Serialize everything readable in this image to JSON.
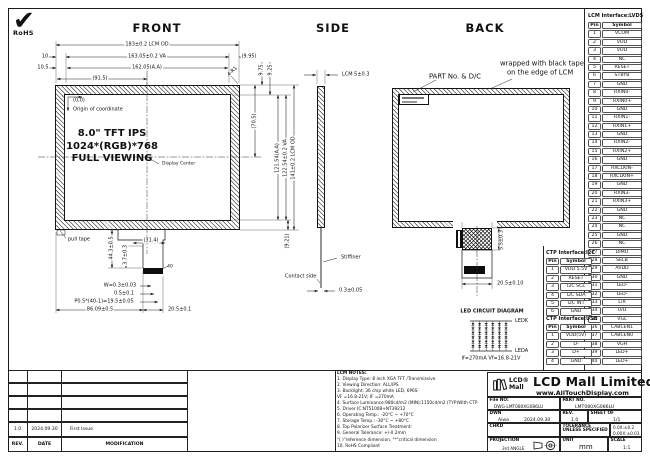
{
  "sheet": {
    "rohs_check": "✔",
    "rohs_label": "RoHS"
  },
  "front": {
    "title": "FRONT",
    "display_lines": [
      "8.0\" TFT IPS",
      "1024*(RGB)*768",
      "FULL VIEWING"
    ],
    "origin_coord": "(0,0)",
    "origin_label": "Origin of coordinate",
    "display_center": "Display Center",
    "pull_tape": "pull tape",
    "dims": {
      "od_w": "183±0.2 LCM OD",
      "va_w": "163.05±0.2 VA",
      "aa_w": "162.05(A.A)",
      "half_w": "(91.5)",
      "m10": "10",
      "m105": "10.5",
      "m995": "(9.95)",
      "r1": "4-R1",
      "m975": "9.75",
      "m925": "9.25",
      "half_h": "(70.5)",
      "aa_h": "121.54(A.A)",
      "va_h": "122.54±0.2 VA",
      "od_h": "141±0.2 LCM OD",
      "m921": "(9.21)",
      "fpc_l": "44.3±0.5",
      "fpc_n": "3.7±0.3",
      "fpc_w": "(31.4)",
      "pin40": "40",
      "pin_w": "W=0.3±0.03",
      "pin_e": "0.5±0.1",
      "pin_p": "P0.5*(40-1)=19.5±0.05",
      "fpc_x": "86.09±0.5",
      "conn_w": "20.5±0.1"
    }
  },
  "side": {
    "title": "SIDE",
    "thk": "LCM 5±0.3",
    "stiffener": "Stiffiner",
    "contact": "Contact side",
    "fpc_thk": "0.3±0.05"
  },
  "back": {
    "title": "BACK",
    "partno_note": "PART No. & D/C",
    "tape_note1": "wrapped with black tape",
    "tape_note2": "on the edge of LCM",
    "fpc_h": "5.5±0.3",
    "conn_w": "20.5±0.10"
  },
  "led": {
    "title": "LED CIRCUIT DIAGRAM",
    "k": "LEDK",
    "a": "LEDA",
    "spec": "If=270mA  Vf=16.8-21V"
  },
  "lvds": {
    "title": "LCM Interface:LVDS",
    "headers": [
      "Pin",
      "Symbol"
    ],
    "rows": [
      [
        "1",
        "VCOM"
      ],
      [
        "2",
        "VDD"
      ],
      [
        "3",
        "VDD"
      ],
      [
        "4",
        "NC"
      ],
      [
        "5",
        "RESET"
      ],
      [
        "6",
        "STBYB"
      ],
      [
        "7",
        "GND"
      ],
      [
        "8",
        "RXIN0-"
      ],
      [
        "9",
        "RXIN0+"
      ],
      [
        "10",
        "GND"
      ],
      [
        "11",
        "RXIN1-"
      ],
      [
        "12",
        "RXIN1+"
      ],
      [
        "13",
        "GND"
      ],
      [
        "14",
        "RXIN2-"
      ],
      [
        "15",
        "RXIN2+"
      ],
      [
        "16",
        "GND"
      ],
      [
        "17",
        "RXCLKIN-"
      ],
      [
        "18",
        "RXCLKIN+"
      ],
      [
        "19",
        "GND"
      ],
      [
        "20",
        "RXIN3-"
      ],
      [
        "21",
        "RXIN3+"
      ],
      [
        "22",
        "GND"
      ],
      [
        "23",
        "NC"
      ],
      [
        "24",
        "NC"
      ],
      [
        "25",
        "GND"
      ],
      [
        "26",
        "NC"
      ],
      [
        "27",
        "DIMO"
      ],
      [
        "28",
        "SELB"
      ],
      [
        "29",
        "AVDD"
      ],
      [
        "30",
        "GND"
      ],
      [
        "31",
        "LED-"
      ],
      [
        "32",
        "LED-"
      ],
      [
        "33",
        "L/R"
      ],
      [
        "34",
        "U/D"
      ],
      [
        "35",
        "VGL"
      ],
      [
        "36",
        "CABCEN1"
      ],
      [
        "37",
        "CABCEN0"
      ],
      [
        "38",
        "VGH"
      ],
      [
        "39",
        "LED+"
      ],
      [
        "40",
        "LED+"
      ]
    ]
  },
  "ctp_i2c": {
    "title": "CTP Interface:I2C",
    "headers": [
      "Pin",
      "Symbol"
    ],
    "rows": [
      [
        "1",
        "VDD 5.5V"
      ],
      [
        "2",
        "RESET"
      ],
      [
        "3",
        "I2C SCL"
      ],
      [
        "4",
        "I2C SDA"
      ],
      [
        "5",
        "I2C INT"
      ],
      [
        "6",
        "GND"
      ]
    ]
  },
  "ctp_usb": {
    "title": "CTP Interface:USB",
    "headers": [
      "Pin",
      "Symbol"
    ],
    "rows": [
      [
        "1",
        "VDD(5V)"
      ],
      [
        "2",
        "D-"
      ],
      [
        "3",
        "D+"
      ],
      [
        "4",
        "GND"
      ]
    ]
  },
  "notes": {
    "title": "LCM NOTES:",
    "lines": [
      "1. Display Type: 8 inch XGA TFT /Transmissive",
      "2. Viewing Direction: ALL/IPS",
      "3. Backlight: 36 chip white LED, 6P6S",
      "    VF =16.8-21V; IF =270mA",
      "4. Surface Luminance:980cd/m2 (MIN);1150cd/m2 (TYP)With CTP",
      "5. Driver IC:NT51008+NT39212",
      "6. Operating Temp.: -20°C ~ +70°C",
      "7. Storage Temp.: -30°C ~ +80°C",
      "8. Top Polarizer Surface Treatment:",
      "9. General Tolerance: +/-0.2mm",
      "    \"( )\"reference dimension, \"*\"critical dimension",
      "10. RoHS Compliant"
    ]
  },
  "revision": {
    "rows": [
      [
        "",
        "",
        ""
      ],
      [
        "",
        "",
        ""
      ],
      [
        "",
        "",
        ""
      ],
      [
        "",
        "",
        ""
      ],
      [
        "1.0",
        "2024.09.30",
        "First Issue"
      ],
      [
        "REV.",
        "DATE",
        "MODIFICATION"
      ]
    ]
  },
  "tb": {
    "logo_line1": "LCD®",
    "logo_line2": "Mall",
    "company": "LCD Mall Limited",
    "website": "www.AllTouchDisplay.com",
    "file_label": "File NO:",
    "file_no": "DWG-LMT080XG086LU",
    "part_label": "PART NO.",
    "part_no": "LMT080XG086LU",
    "dwn_label": "DWN",
    "dwn_name": "Aiwa",
    "dwn_date": "2024.09.30",
    "rev_label": "REV.",
    "rev": "1.0",
    "sheet_label": "SHEET OF",
    "sheet": "1/1",
    "chkd_label": "CHKD",
    "tol_label": "TOLERANCE UNLESS SPECIFIED",
    "tol1": "0.0X:±0.2",
    "tol2": "0.00X:±0.03",
    "proj_label": "PROJECTION",
    "proj": "3rd ANGLE",
    "unit_label": "UNIT",
    "unit": "mm",
    "scale_label": "SCALE",
    "scale": "1:1"
  }
}
